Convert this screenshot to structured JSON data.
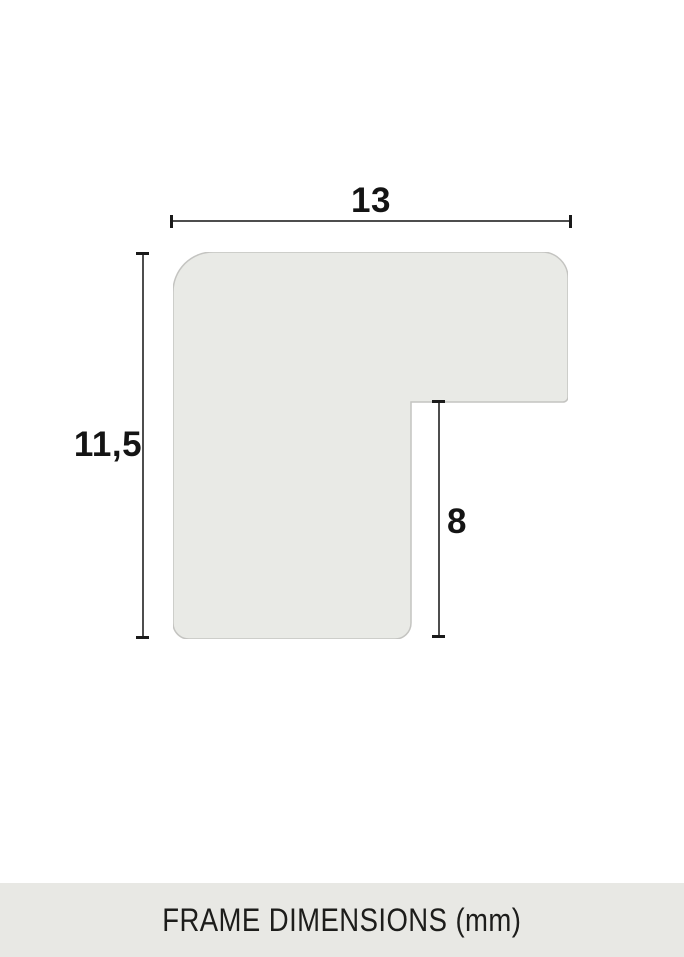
{
  "diagram": {
    "dimensions": {
      "top": {
        "value": "13"
      },
      "left": {
        "value": "11,5"
      },
      "inner": {
        "value": "8"
      }
    },
    "unit": "mm"
  },
  "footer": {
    "label": "FRAME DIMENSIONS (mm)"
  },
  "colors": {
    "shape_fill": "#e9eae6",
    "shape_border": "#c4c4c1",
    "dimension_line": "#4e4e4e",
    "tick": "#1a1a1a",
    "label_text": "#141414",
    "footer_background": "#e8e8e4",
    "footer_text": "#1d1d1b",
    "page_background": "#ffffff"
  }
}
